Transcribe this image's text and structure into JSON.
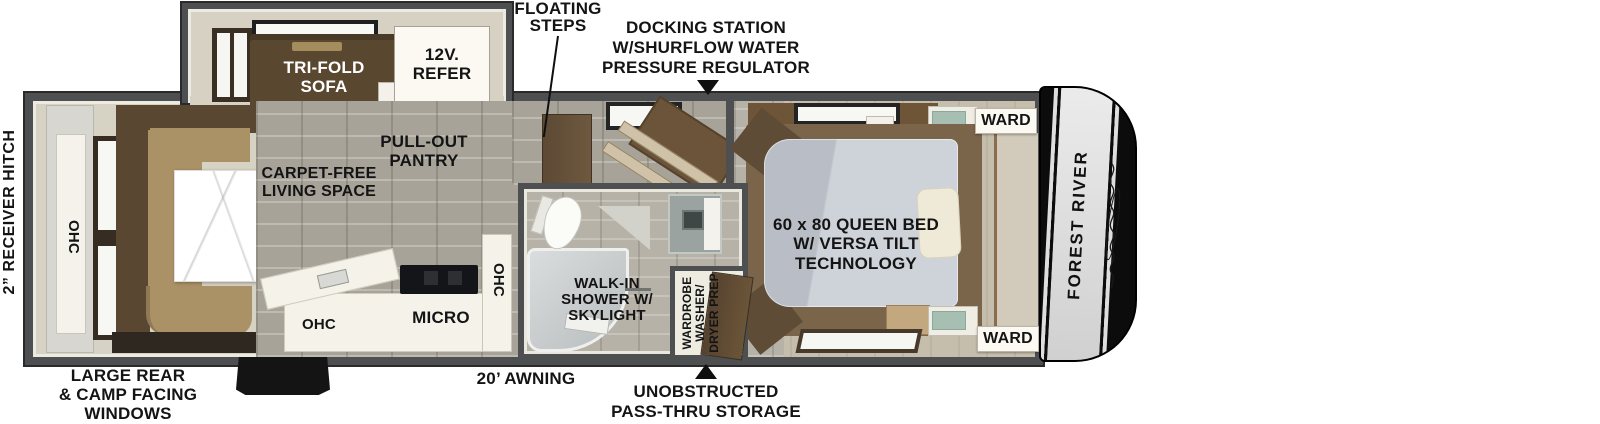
{
  "diagram": {
    "type": "rv-floorplan",
    "brand": "FOREST RIVER"
  },
  "labels": {
    "receiver_hitch": "2” RECEIVER HITCH",
    "floating_steps": "FLOATING\nSTEPS",
    "docking_station": "DOCKING STATION\nW/SHURFLOW WATER\nPRESSURE REGULATOR",
    "trifold_sofa": "TRI-FOLD\nSOFA",
    "refer": "12V.\nREFER",
    "pullout_pantry": "PULL-OUT\nPANTRY",
    "carpet_free": "CARPET-FREE\nLIVING SPACE",
    "ohc_rear": "OHC",
    "ohc_kitchen": "OHC",
    "micro": "MICRO",
    "ohc_kitchen_upper": "OHC",
    "walk_in_shower": "WALK-IN\nSHOWER W/\nSKYLIGHT",
    "wardrobe_washer": "WARDROBE\nWASHER/\nDRYER PREP",
    "queen_bed": "60 x 80 QUEEN BED\nW/ VERSA TILT\nTECHNOLOGY",
    "ward_top": "WARD",
    "ward_bottom": "WARD",
    "awning": "20’ AWNING",
    "pass_thru": "UNOBSTRUCTED\nPASS-THRU STORAGE",
    "rear_windows": "LARGE REAR\n& CAMP FACING\nWINDOWS",
    "brand": "FOREST RIVER"
  },
  "icons": {
    "docking_arrow": "arrow-down",
    "passthru_arrow": "arrow-up"
  },
  "colors": {
    "wall": "#4e4f51",
    "wall_edge": "#2a2a2a",
    "interior": "#d6d2c4",
    "stone_floor": "#a7a399",
    "sofa_brown": "#5a4730",
    "cushion_tan": "#ab9166",
    "mattress_gray": "#c3c7cf",
    "pillow_cream": "#efe9d8",
    "teal_cabinet": "#a6bfb2",
    "white_box": "#fbf9f2",
    "front_cap": "#0c0c0c",
    "cap_band": "#e0e0e0",
    "label_text": "#141414"
  }
}
